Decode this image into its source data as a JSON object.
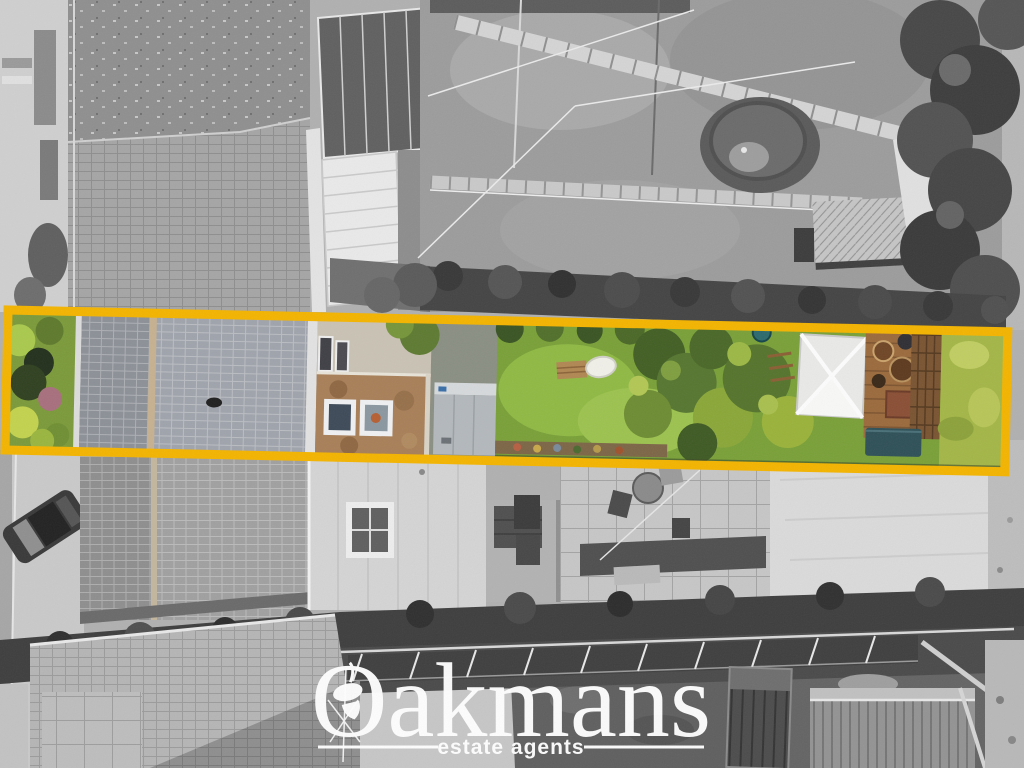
{
  "watermark": {
    "brand": "Oakmans",
    "tagline": "estate agents",
    "color": "#FFFFFF"
  },
  "highlight": {
    "color": "#F3B400",
    "shape": "rectangle"
  }
}
